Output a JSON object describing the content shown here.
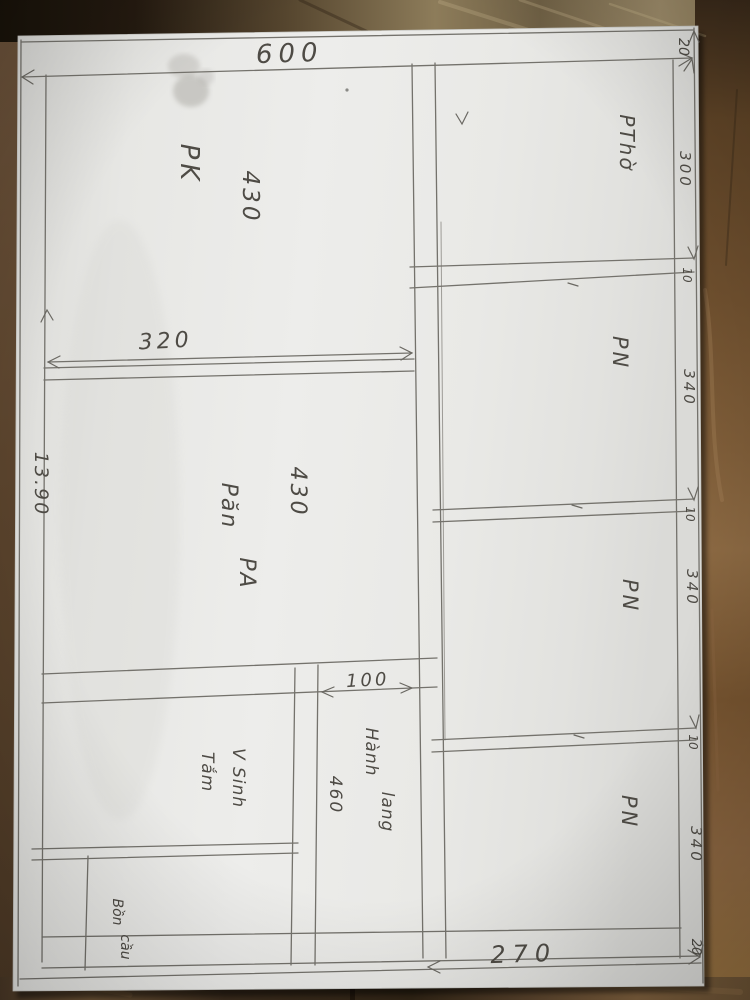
{
  "plan": {
    "dimensions": {
      "total_width": "600",
      "total_height": "13.90",
      "living_width": "320",
      "living_length": "430",
      "dining_length": "430",
      "hall_width": "100",
      "hall_length": "460",
      "right_section_width": "270",
      "wall_top": "20",
      "worship_length": "300",
      "wall_a": "10",
      "bedroom1_length": "340",
      "wall_b": "10",
      "bedroom2_length": "340",
      "wall_c": "10",
      "bedroom3_length": "340",
      "wall_bottom": "20"
    },
    "rooms": {
      "living": "PK",
      "worship": "PThờ",
      "bedroom1": "PN",
      "bedroom2": "PN",
      "bedroom3": "PN",
      "dining_line1": "Păn",
      "dining_line2": "PA",
      "bath_line1": "V Sinh",
      "bath_line2": "Tắm",
      "hall_line1": "Hành",
      "hall_line2": "lang",
      "toilet_line1": "Bồn",
      "toilet_line2": "cầu"
    },
    "colors": {
      "pencil": "#74726c",
      "ink_text": "#4e4b45",
      "paper": "#e9e9e6",
      "wood_dark": "#241a10",
      "wood_mid": "#6b523a",
      "wood_light": "#96713f"
    }
  }
}
